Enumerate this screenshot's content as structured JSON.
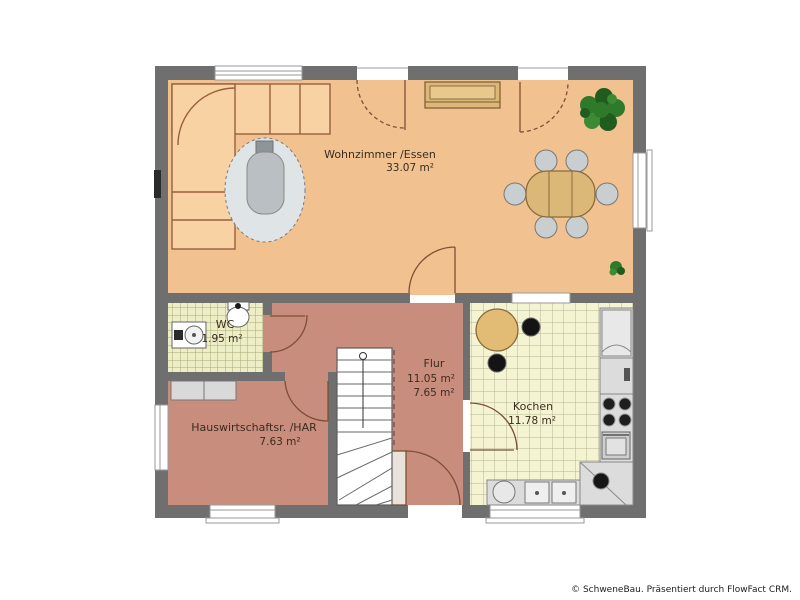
{
  "rooms": {
    "wohnzimmer": {
      "label": "Wohnzimmer /Essen",
      "area": "33.07 m²"
    },
    "wc": {
      "label": "WC",
      "area": "1.95 m²"
    },
    "hwr": {
      "label": "Hauswirtschaftsr. /HAR",
      "area": "7.63 m²"
    },
    "flur": {
      "label": "Flur",
      "area_total": "11.05 m²",
      "area_net": "7.65 m²"
    },
    "kueche": {
      "label": "Kochen",
      "area": "11.78 m²"
    }
  },
  "footer": {
    "credit": "© SchweneBau. Präsentiert durch FlowFact CRM."
  },
  "colors": {
    "wall": "#6f6f6f",
    "living_floor": "#f2c190",
    "hall_floor": "#c98d7d",
    "wc_tile": "#edeec5",
    "kitchen_tile": "#f4f4d3",
    "sofa": "#f8d2a2",
    "wood": "#ddb16c",
    "plant_green": "#2f7a2a",
    "appliance_gray": "#dcdcdc"
  }
}
